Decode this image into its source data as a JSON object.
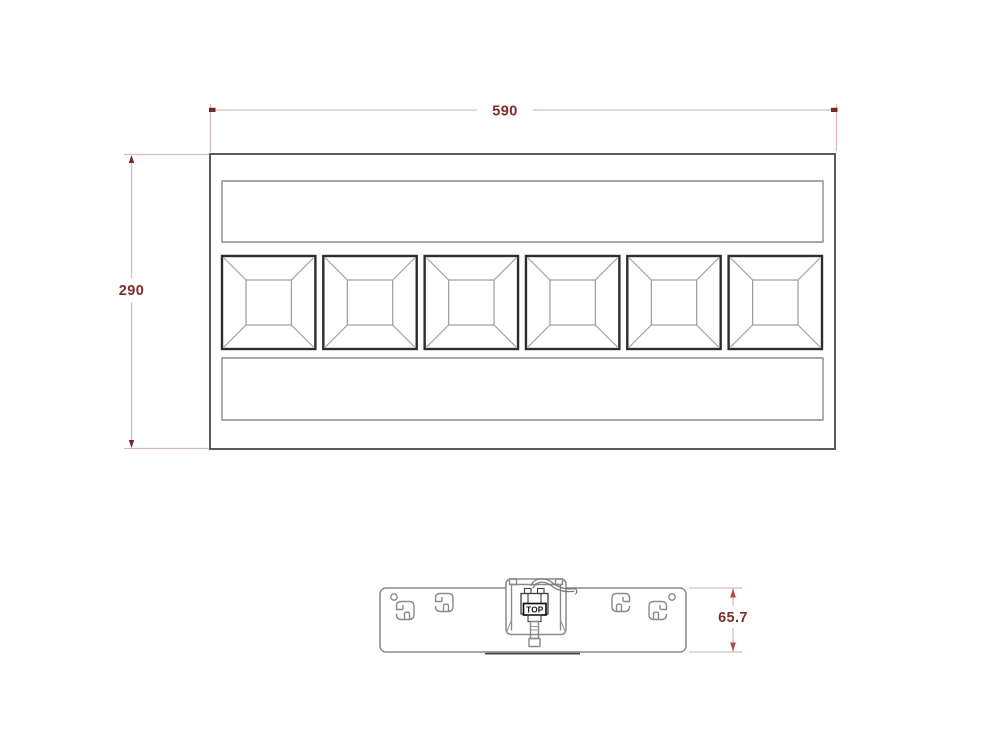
{
  "top_view": {
    "width_dim": "590",
    "height_dim": "290",
    "module_count": 6
  },
  "side_view": {
    "height_dim": "65.7",
    "connector_label": "TOP",
    "clip_count": 4,
    "hole_count": 2
  },
  "colors": {
    "dimension_text": "#842c2c",
    "dimension_line": "#d9bdbd",
    "dimension_marker": "#7a2525",
    "dimension_arrow": "#b04a4a",
    "outline_dark": "#5a5a5a",
    "outline_mid": "#8a8a8a",
    "module_border": "#2d2d2d",
    "background": "#ffffff"
  }
}
